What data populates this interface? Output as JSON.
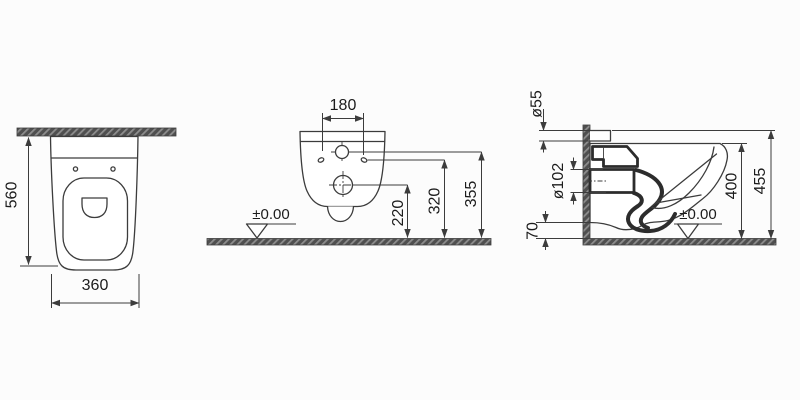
{
  "views": {
    "top": {
      "depth": "560",
      "width": "360"
    },
    "rear": {
      "hole_spacing": "180",
      "outlet_height": "220",
      "holes_height": "320",
      "inlet_height": "355",
      "datum": "±0.00"
    },
    "side": {
      "inlet_diameter": "ø55",
      "outlet_diameter": "ø102",
      "floor_clearance": "70",
      "rim_height": "400",
      "overall_height": "455",
      "datum": "±0.00"
    }
  },
  "colors": {
    "line": "#3c3c3c",
    "section_fill": "#4f4f4f",
    "section_stripe": "#8d8d8d",
    "background": "#fcfcfc",
    "text": "#1c1c1c"
  }
}
